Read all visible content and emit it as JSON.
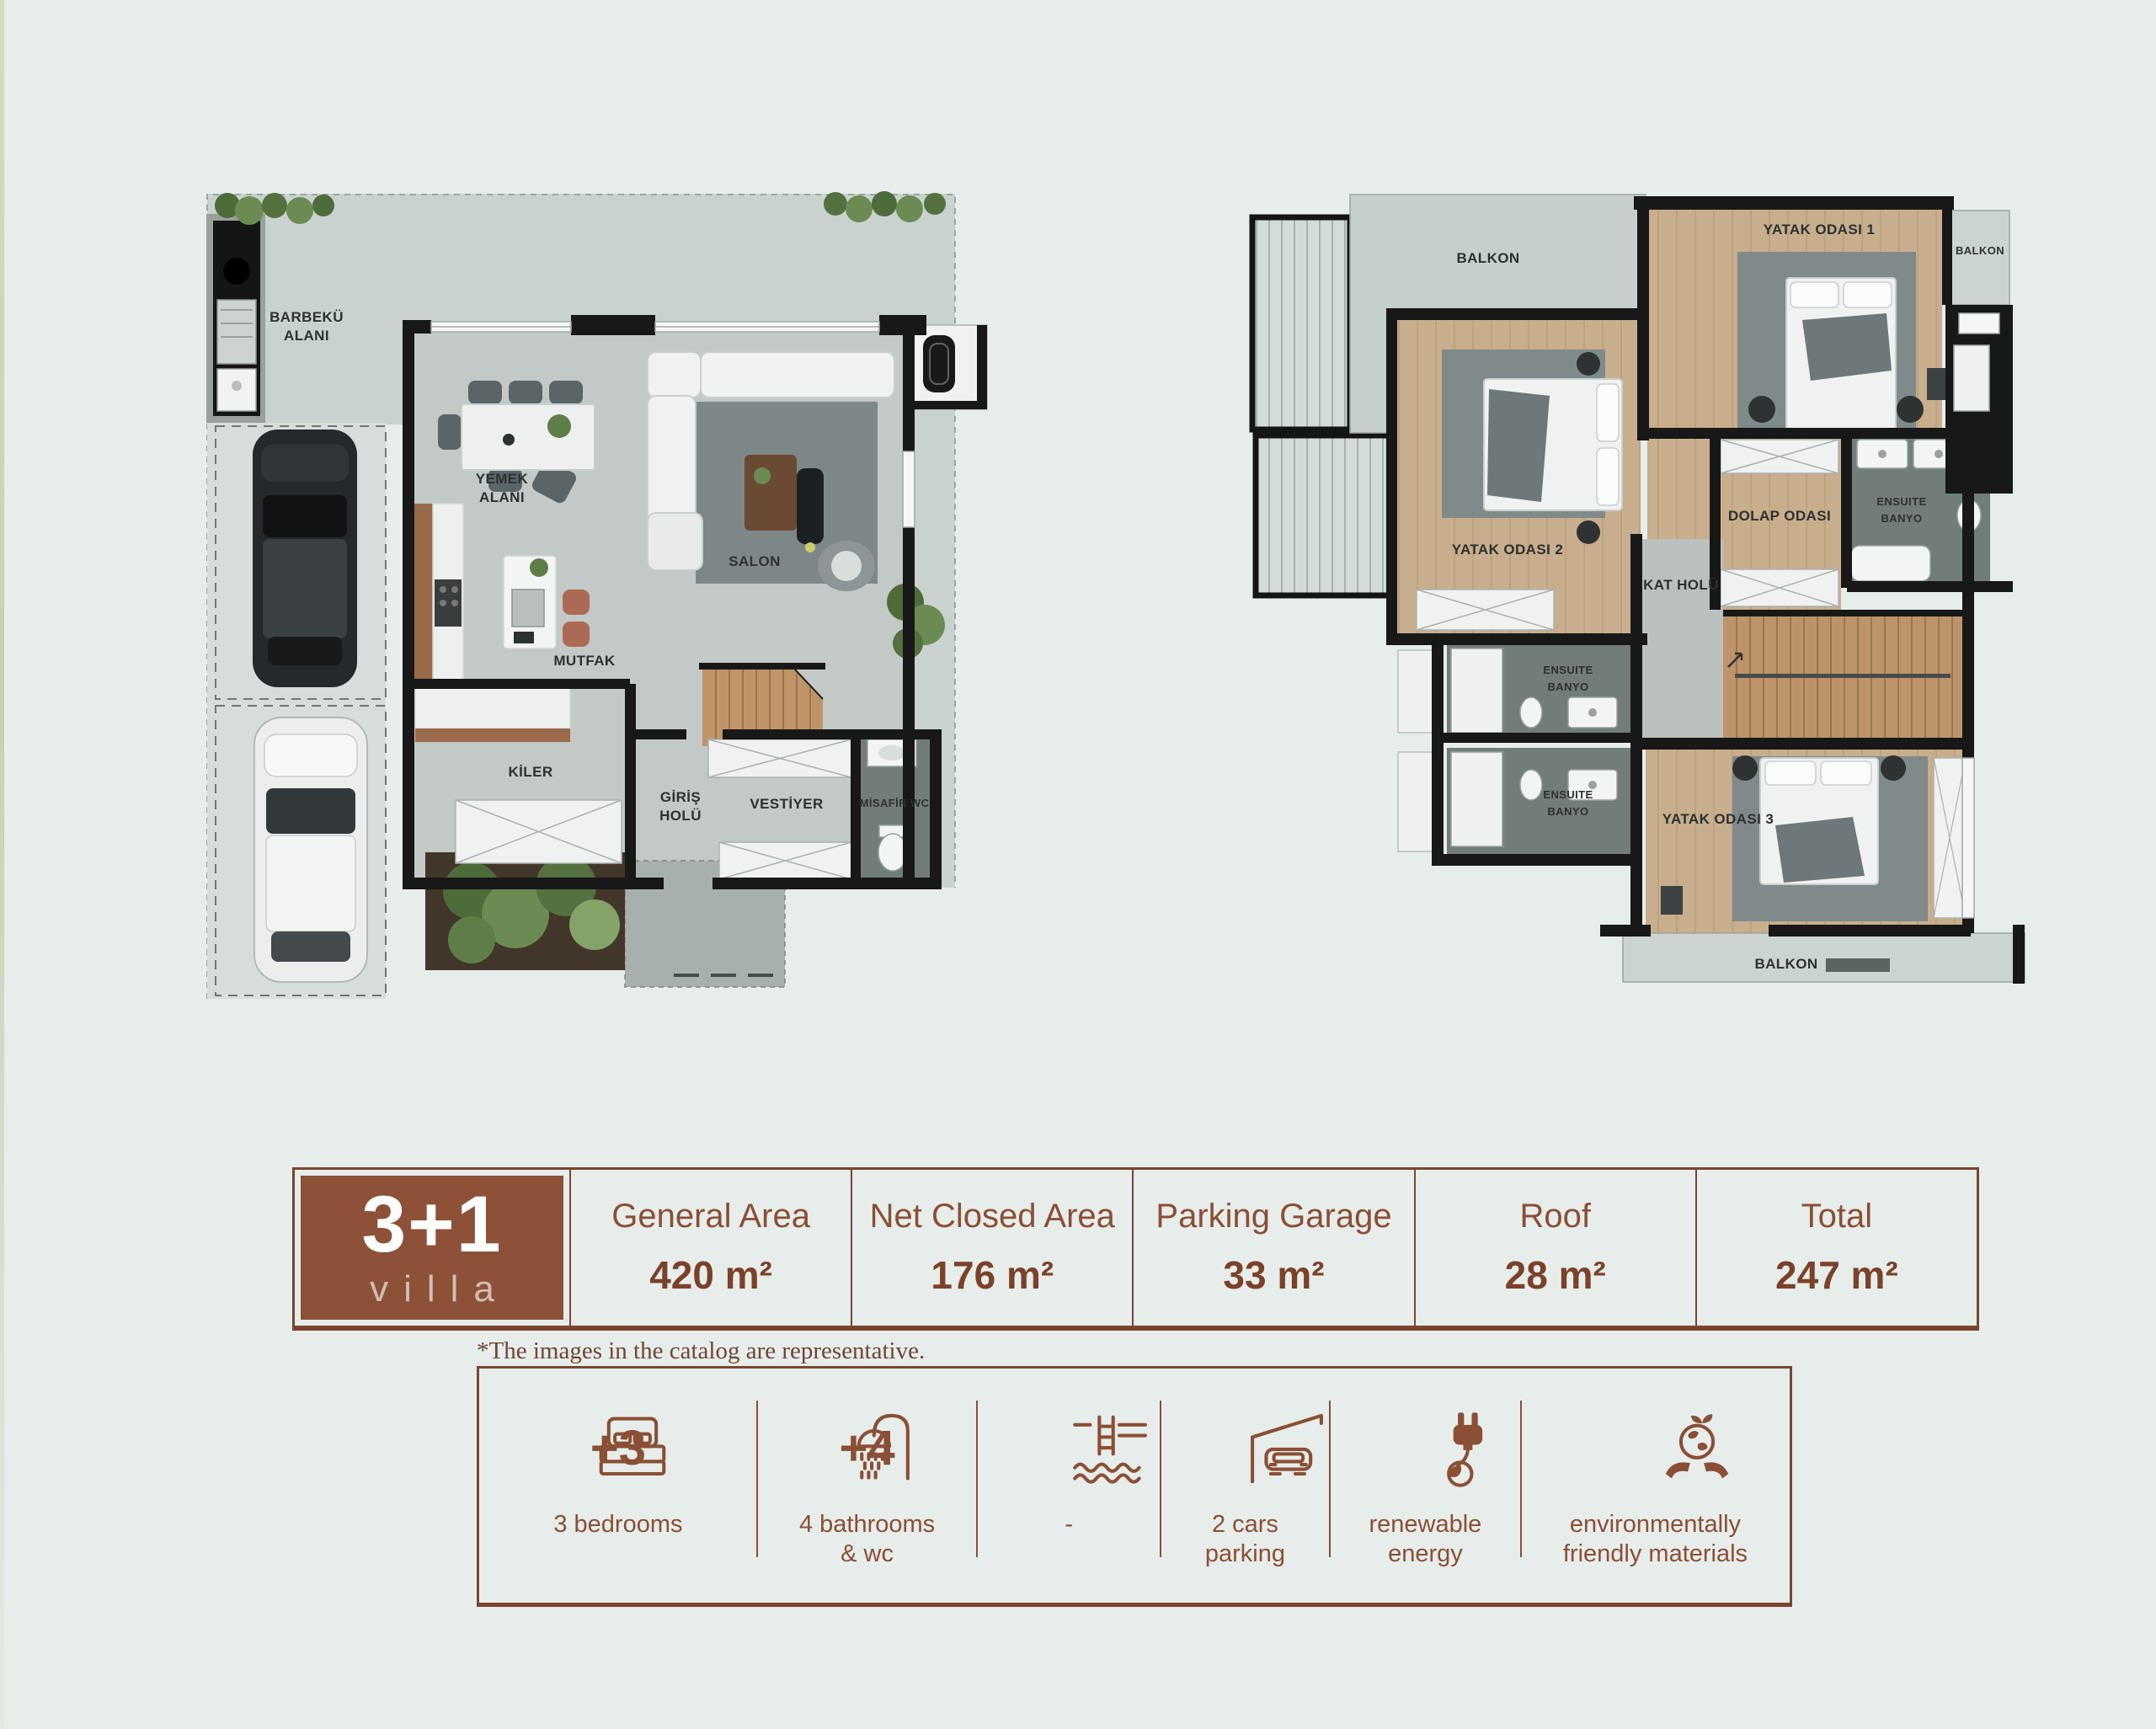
{
  "page": {
    "background": "#e7edeb",
    "accent_brown": "#8a4f35",
    "note": "*The images in the catalog are representative."
  },
  "ground_floor": {
    "labels": {
      "barbeku_1": "BARBEKÜ",
      "barbeku_2": "ALANI",
      "yemek_1": "YEMEK",
      "yemek_2": "ALANI",
      "salon": "SALON",
      "mutfak": "MUTFAK",
      "kiler": "KİLER",
      "giris_1": "GİRİŞ",
      "giris_2": "HOLÜ",
      "vestiyer": "VESTİYER",
      "misafir_wc": "MİSAFİR WC"
    }
  },
  "upper_floor": {
    "labels": {
      "balkon_top": "BALKON",
      "yatak_odasi_1": "YATAK ODASI 1",
      "balkon_right": "BALKON",
      "yatak_odasi_2": "YATAK ODASI 2",
      "dolap_odasi": "DOLAP ODASI",
      "ensuite_right_1": "ENSUITE",
      "ensuite_right_2": "BANYO",
      "kat_holu": "KAT HOLÜ",
      "ensuite_mid_1": "ENSUITE",
      "ensuite_mid_2": "BANYO",
      "ensuite_low_1": "ENSUITE",
      "ensuite_low_2": "BANYO",
      "yatak_odasi_3": "YATAK ODASI 3",
      "balkon_bottom": "BALKON"
    }
  },
  "spec_table": {
    "badge_title": "3+1",
    "badge_subtitle": "villa",
    "columns": [
      {
        "label": "General Area",
        "value": "420 m²"
      },
      {
        "label": "Net Closed Area",
        "value": "176 m²"
      },
      {
        "label": "Parking Garage",
        "value": "33 m²"
      },
      {
        "label": "Roof",
        "value": "28 m²"
      },
      {
        "label": "Total",
        "value": "247 m²"
      }
    ]
  },
  "features": [
    {
      "icon": "bed-icon",
      "badge": "+3",
      "label": "3 bedrooms"
    },
    {
      "icon": "shower-icon",
      "badge": "+4",
      "label": "4 bathrooms\n& wc"
    },
    {
      "icon": "pool-icon",
      "badge": "",
      "label": "-"
    },
    {
      "icon": "carport-icon",
      "badge": "",
      "label": "2 cars\nparking"
    },
    {
      "icon": "plug-icon",
      "badge": "",
      "label": "renewable\nenergy"
    },
    {
      "icon": "eco-icon",
      "badge": "",
      "label": "environmentally\nfriendly materials"
    }
  ]
}
